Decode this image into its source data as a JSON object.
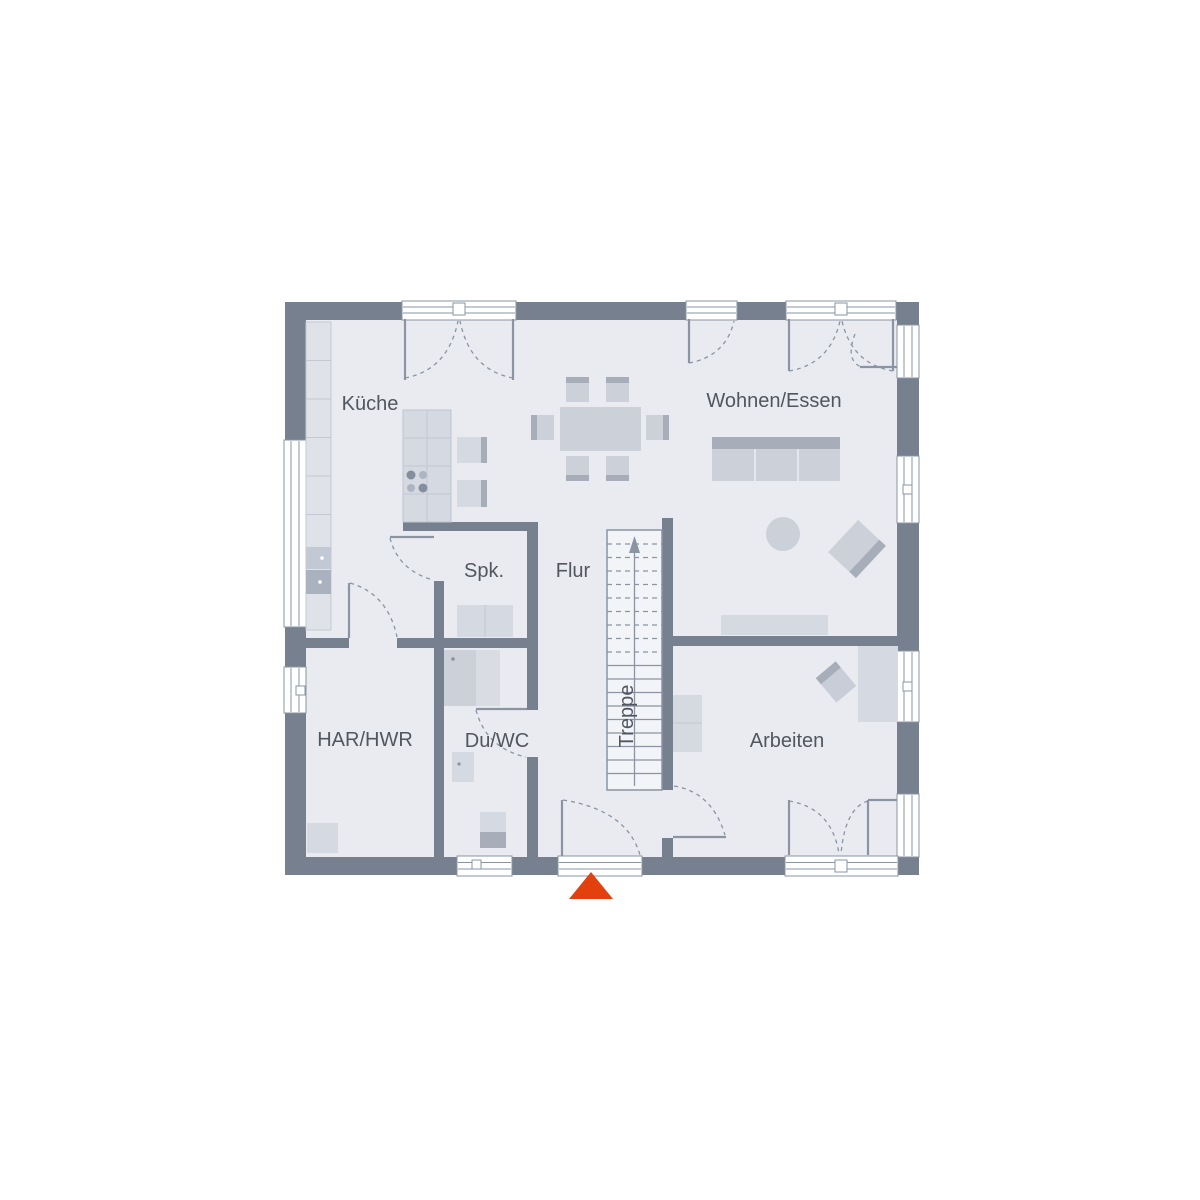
{
  "labels": {
    "kueche": "Küche",
    "wohnen_essen": "Wohnen/Essen",
    "spk": "Spk.",
    "flur": "Flur",
    "treppe": "Treppe",
    "har_hwr": "HAR/HWR",
    "du_wc": "Du/WC",
    "arbeiten": "Arbeiten"
  },
  "colors": {
    "wall": "#76808f",
    "floor": "#e9ebf1",
    "furniture": "#ccd0d9",
    "furniture_mid": "#d5d9e1",
    "furniture_dark": "#a7aeba",
    "counter": "#dfe2e8",
    "counter_line": "#c3c8d2",
    "line": "#8a94a3",
    "text": "#51565f",
    "window_fill": "#ffffff",
    "stair_fill": "#f2f4f7",
    "entrance_arrow": "#e2410e"
  }
}
